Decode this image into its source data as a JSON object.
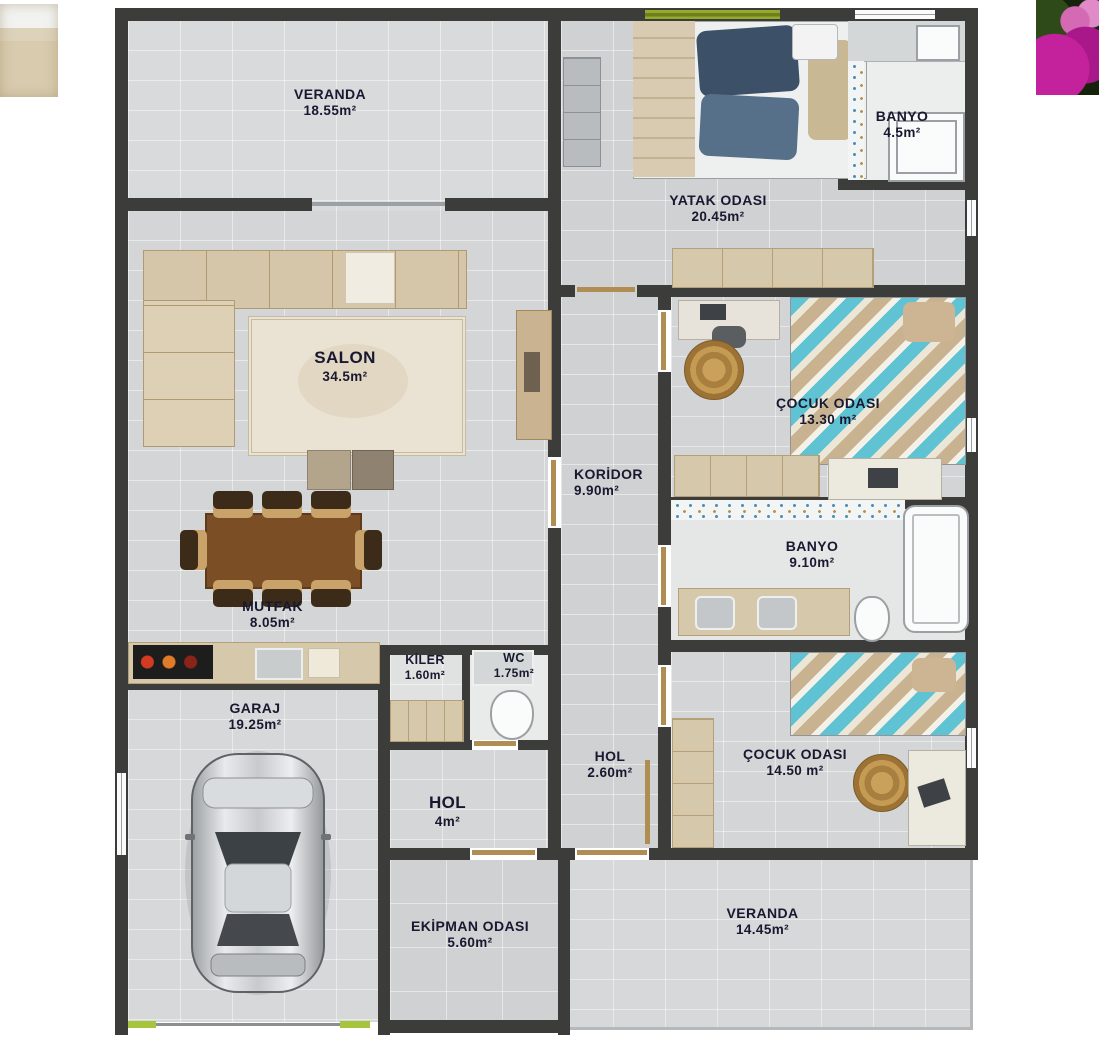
{
  "plan": {
    "type": "residential-floor-plan",
    "rooms": [
      {
        "name": "VERANDA",
        "area": "18.55m²"
      },
      {
        "name": "YATAK ODASI",
        "area": "20.45m²"
      },
      {
        "name": "BANYO",
        "area": "4.5m²"
      },
      {
        "name": "SALON",
        "area": "34.5m²"
      },
      {
        "name": "ÇOCUK ODASI",
        "area": "13.30 m²"
      },
      {
        "name": "KORİDOR",
        "area": "9.90m²"
      },
      {
        "name": "BANYO",
        "area": "9.10m²"
      },
      {
        "name": "MUTFAK",
        "area": "8.05m²"
      },
      {
        "name": "KİLER",
        "area": "1.60m²"
      },
      {
        "name": "WC",
        "area": "1.75m²"
      },
      {
        "name": "GARAJ",
        "area": "19.25m²"
      },
      {
        "name": "HOL",
        "area": "2.60m²"
      },
      {
        "name": "HOL",
        "area": "4m²"
      },
      {
        "name": "ÇOCUK ODASI",
        "area": "14.50 m²"
      },
      {
        "name": "EKİPMAN ODASI",
        "area": "5.60m²"
      },
      {
        "name": "VERANDA",
        "area": "14.45m²"
      }
    ],
    "colors": {
      "wall": "#3c3c3a",
      "floor_light": "#d5d7d8",
      "accent_lime": "#a7c43d",
      "window_green": "#7d921d",
      "turquoise": "#5fc3d3",
      "beige_furniture": "#d6c8ab",
      "wood_brown": "#7c4e26",
      "label_text": "#181830"
    },
    "decorations": {
      "top_left": "stone-texture-photo-fragment",
      "top_right": "pink-bougainvillea-photo-fragment"
    }
  }
}
